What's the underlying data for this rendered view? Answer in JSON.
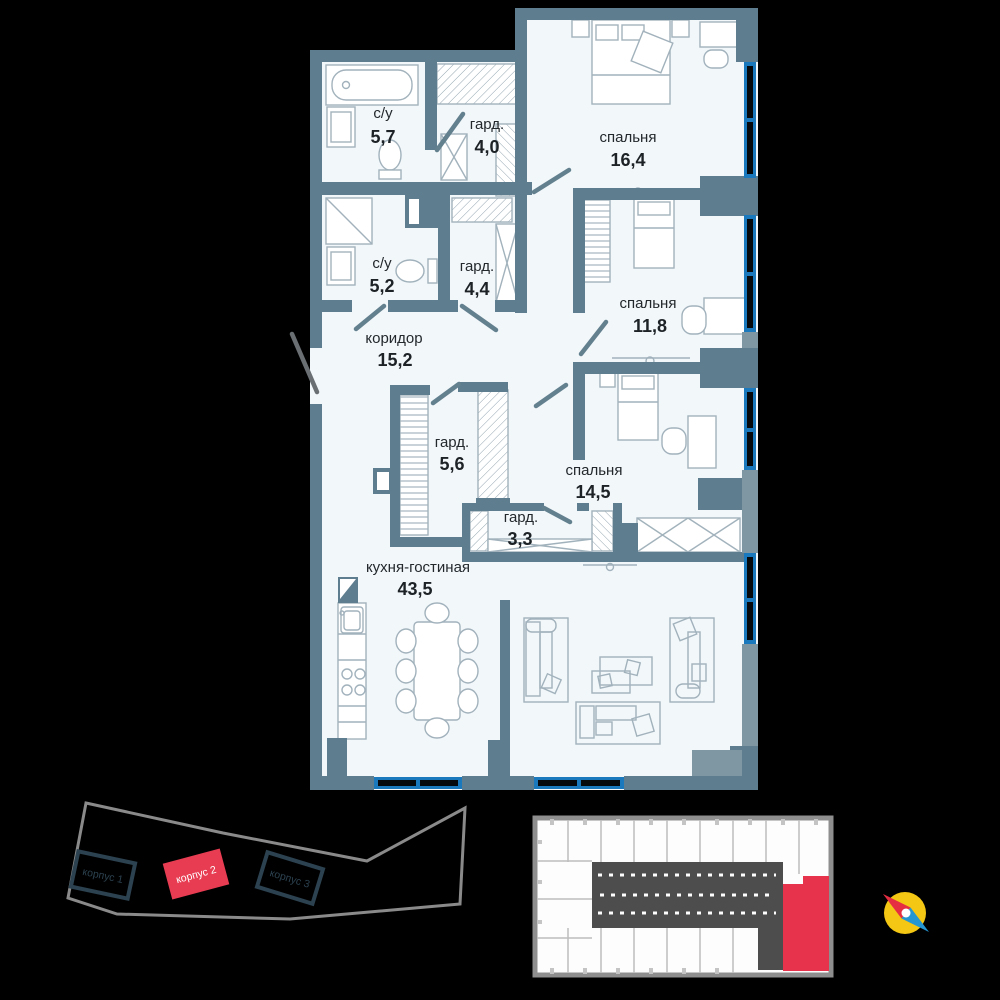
{
  "floorplan": {
    "rooms": [
      {
        "name": "с/у",
        "area": "5,7"
      },
      {
        "name": "гард.",
        "area": "4,0"
      },
      {
        "name": "спальня",
        "area": "16,4"
      },
      {
        "name": "с/у",
        "area": "5,2"
      },
      {
        "name": "гард.",
        "area": "4,4"
      },
      {
        "name": "спальня",
        "area": "11,8"
      },
      {
        "name": "коридор",
        "area": "15,2"
      },
      {
        "name": "гард.",
        "area": "5,6"
      },
      {
        "name": "спальня",
        "area": "14,5"
      },
      {
        "name": "гард.",
        "area": "3,3"
      },
      {
        "name": "кухня-гостиная",
        "area": "43,5"
      }
    ]
  },
  "site_plan": {
    "buildings": [
      {
        "label": "корпус 1",
        "highlighted": false
      },
      {
        "label": "корпус 2",
        "highlighted": true
      },
      {
        "label": "корпус 3",
        "highlighted": false
      }
    ]
  },
  "key_plan": {
    "highlighted_unit": "selected apartment"
  },
  "colors": {
    "wall": "#5e7d8e",
    "wall_light": "#7f96a3",
    "room_fill": "#f2f7fa",
    "window_blue": "#1a78bd",
    "accent_red": "#e8334d",
    "site_outline": "#8a8a8a",
    "building_outline": "#2c4250",
    "compass_yellow": "#f3c713",
    "compass_blue": "#2596d1"
  }
}
